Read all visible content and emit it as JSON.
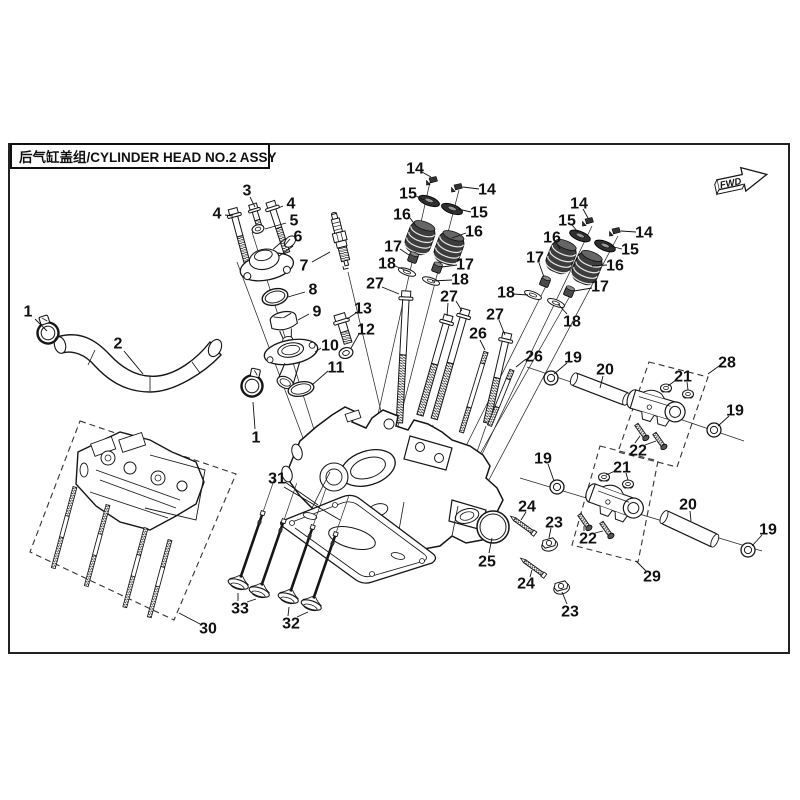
{
  "frame": {
    "title": "后气缸盖组/CYLINDER HEAD NO.2 ASSY",
    "fwd_label": "FWD"
  },
  "diagram": {
    "type": "exploded-parts-diagram",
    "subject": "cylinder head no.2 assembly",
    "line_color": "#161616",
    "background": "#ffffff",
    "callouts": [
      {
        "n": "1",
        "x": 28,
        "y": 311,
        "l": [
          [
            35,
            319,
            47,
            331
          ]
        ]
      },
      {
        "n": "1",
        "x": 256,
        "y": 437,
        "l": [
          [
            255,
            429,
            253,
            402
          ]
        ]
      },
      {
        "n": "2",
        "x": 118,
        "y": 343,
        "l": [
          [
            124,
            351,
            143,
            374
          ]
        ]
      },
      {
        "n": "3",
        "x": 247,
        "y": 190,
        "l": [
          [
            250,
            197,
            255,
            207
          ]
        ]
      },
      {
        "n": "4",
        "x": 217,
        "y": 213,
        "l": [
          [
            225,
            215,
            233,
            216
          ]
        ]
      },
      {
        "n": "4",
        "x": 291,
        "y": 203,
        "l": [
          [
            283,
            206,
            276,
            209
          ]
        ]
      },
      {
        "n": "5",
        "x": 294,
        "y": 220,
        "l": [
          [
            286,
            223,
            265,
            229
          ]
        ]
      },
      {
        "n": "6",
        "x": 298,
        "y": 236,
        "l": [
          [
            290,
            239,
            284,
            246
          ]
        ]
      },
      {
        "n": "7",
        "x": 304,
        "y": 265,
        "l": [
          [
            312,
            262,
            330,
            252
          ]
        ]
      },
      {
        "n": "8",
        "x": 313,
        "y": 289,
        "l": [
          [
            305,
            292,
            288,
            297
          ]
        ]
      },
      {
        "n": "9",
        "x": 317,
        "y": 311,
        "l": [
          [
            309,
            314,
            298,
            320
          ]
        ]
      },
      {
        "n": "10",
        "x": 330,
        "y": 345,
        "l": [
          [
            321,
            348,
            315,
            352
          ]
        ]
      },
      {
        "n": "11",
        "x": 336,
        "y": 367,
        "l": [
          [
            328,
            371,
            312,
            385
          ]
        ]
      },
      {
        "n": "12",
        "x": 366,
        "y": 329,
        "l": [
          [
            359,
            334,
            351,
            348
          ]
        ]
      },
      {
        "n": "13",
        "x": 363,
        "y": 308,
        "l": [
          [
            356,
            313,
            347,
            319
          ]
        ]
      },
      {
        "n": "14",
        "x": 415,
        "y": 168,
        "l": [
          [
            422,
            172,
            431,
            177
          ]
        ]
      },
      {
        "n": "14",
        "x": 487,
        "y": 189,
        "l": [
          [
            479,
            189,
            463,
            187
          ]
        ]
      },
      {
        "n": "14",
        "x": 579,
        "y": 203,
        "l": [
          [
            583,
            209,
            588,
            218
          ]
        ]
      },
      {
        "n": "14",
        "x": 644,
        "y": 232,
        "l": [
          [
            636,
            232,
            621,
            231
          ]
        ]
      },
      {
        "n": "15",
        "x": 408,
        "y": 193,
        "l": [
          [
            416,
            196,
            424,
            200
          ]
        ]
      },
      {
        "n": "15",
        "x": 479,
        "y": 212,
        "l": [
          [
            471,
            212,
            458,
            209
          ]
        ]
      },
      {
        "n": "15",
        "x": 567,
        "y": 220,
        "l": [
          [
            572,
            225,
            578,
            232
          ]
        ]
      },
      {
        "n": "15",
        "x": 630,
        "y": 249,
        "l": [
          [
            622,
            249,
            610,
            246
          ]
        ]
      },
      {
        "n": "16",
        "x": 402,
        "y": 214,
        "l": [
          [
            410,
            218,
            416,
            226
          ]
        ]
      },
      {
        "n": "16",
        "x": 474,
        "y": 231,
        "l": [
          [
            466,
            233,
            452,
            238
          ]
        ]
      },
      {
        "n": "16",
        "x": 552,
        "y": 237,
        "l": [
          [
            556,
            242,
            560,
            249
          ]
        ]
      },
      {
        "n": "16",
        "x": 615,
        "y": 265,
        "l": [
          [
            607,
            265,
            592,
            266
          ]
        ]
      },
      {
        "n": "17",
        "x": 393,
        "y": 246,
        "l": [
          [
            400,
            249,
            409,
            255
          ]
        ]
      },
      {
        "n": "17",
        "x": 465,
        "y": 264,
        "l": [
          [
            457,
            265,
            442,
            267
          ]
        ]
      },
      {
        "n": "17",
        "x": 535,
        "y": 257,
        "l": [
          [
            539,
            263,
            544,
            277
          ]
        ]
      },
      {
        "n": "17",
        "x": 600,
        "y": 286,
        "l": [
          [
            592,
            288,
            574,
            291
          ]
        ]
      },
      {
        "n": "18",
        "x": 387,
        "y": 263,
        "l": [
          [
            395,
            266,
            410,
            272
          ]
        ]
      },
      {
        "n": "18",
        "x": 460,
        "y": 279,
        "l": [
          [
            452,
            280,
            432,
            281
          ]
        ]
      },
      {
        "n": "18",
        "x": 506,
        "y": 292,
        "l": [
          [
            513,
            294,
            528,
            295
          ]
        ]
      },
      {
        "n": "18",
        "x": 572,
        "y": 321,
        "l": [
          [
            567,
            314,
            558,
            304
          ]
        ]
      },
      {
        "n": "19",
        "x": 573,
        "y": 357,
        "l": [
          [
            567,
            363,
            554,
            374
          ]
        ]
      },
      {
        "n": "19",
        "x": 735,
        "y": 410,
        "l": [
          [
            729,
            416,
            718,
            426
          ]
        ]
      },
      {
        "n": "19",
        "x": 543,
        "y": 458,
        "l": [
          [
            548,
            464,
            554,
            481
          ]
        ]
      },
      {
        "n": "19",
        "x": 768,
        "y": 529,
        "l": [
          [
            762,
            535,
            752,
            546
          ]
        ]
      },
      {
        "n": "20",
        "x": 605,
        "y": 369,
        "l": [
          [
            603,
            376,
            600,
            388
          ]
        ]
      },
      {
        "n": "20",
        "x": 688,
        "y": 504,
        "l": [
          [
            690,
            511,
            691,
            521
          ]
        ]
      },
      {
        "n": "21",
        "x": 683,
        "y": 376,
        "l": [
          [
            676,
            380,
            668,
            386
          ],
          [
            687,
            382,
            688,
            390
          ]
        ]
      },
      {
        "n": "21",
        "x": 622,
        "y": 467,
        "l": [
          [
            615,
            471,
            606,
            475
          ],
          [
            626,
            473,
            628,
            480
          ]
        ]
      },
      {
        "n": "22",
        "x": 638,
        "y": 450,
        "l": [
          [
            635,
            443,
            640,
            436
          ],
          [
            645,
            445,
            656,
            441
          ]
        ]
      },
      {
        "n": "22",
        "x": 588,
        "y": 538,
        "l": [
          [
            584,
            531,
            584,
            526
          ],
          [
            595,
            533,
            603,
            531
          ]
        ]
      },
      {
        "n": "23",
        "x": 554,
        "y": 522,
        "l": [
          [
            551,
            528,
            549,
            538
          ]
        ]
      },
      {
        "n": "23",
        "x": 570,
        "y": 611,
        "l": [
          [
            567,
            604,
            562,
            592
          ]
        ]
      },
      {
        "n": "24",
        "x": 527,
        "y": 506,
        "l": [
          [
            526,
            512,
            521,
            520
          ]
        ]
      },
      {
        "n": "24",
        "x": 526,
        "y": 583,
        "l": [
          [
            530,
            577,
            532,
            570
          ]
        ]
      },
      {
        "n": "25",
        "x": 487,
        "y": 561,
        "l": [
          [
            489,
            553,
            492,
            538
          ]
        ]
      },
      {
        "n": "26",
        "x": 478,
        "y": 333,
        "l": [
          [
            480,
            340,
            485,
            350
          ]
        ]
      },
      {
        "n": "26",
        "x": 534,
        "y": 356,
        "l": [
          [
            526,
            359,
            516,
            367
          ]
        ]
      },
      {
        "n": "27",
        "x": 375,
        "y": 283,
        "l": [
          [
            382,
            287,
            399,
            294
          ]
        ]
      },
      {
        "n": "27",
        "x": 449,
        "y": 296,
        "l": [
          [
            448,
            303,
            447,
            316
          ],
          [
            456,
            301,
            462,
            311
          ]
        ]
      },
      {
        "n": "27",
        "x": 495,
        "y": 314,
        "l": [
          [
            499,
            320,
            505,
            335
          ]
        ]
      },
      {
        "n": "28",
        "x": 727,
        "y": 362,
        "l": [
          [
            719,
            366,
            708,
            374
          ]
        ]
      },
      {
        "n": "29",
        "x": 652,
        "y": 576,
        "l": [
          [
            646,
            571,
            636,
            561
          ]
        ]
      },
      {
        "n": "30",
        "x": 208,
        "y": 628,
        "l": [
          [
            200,
            624,
            179,
            613
          ]
        ]
      },
      {
        "n": "31",
        "x": 277,
        "y": 478,
        "l": [
          [
            285,
            482,
            318,
            505
          ],
          [
            284,
            487,
            340,
            520
          ]
        ]
      },
      {
        "n": "32",
        "x": 291,
        "y": 623,
        "l": [
          [
            288,
            616,
            289,
            607
          ],
          [
            297,
            617,
            308,
            612
          ]
        ]
      },
      {
        "n": "33",
        "x": 240,
        "y": 608,
        "l": [
          [
            238,
            601,
            238,
            593
          ],
          [
            247,
            602,
            256,
            599
          ]
        ]
      }
    ]
  }
}
